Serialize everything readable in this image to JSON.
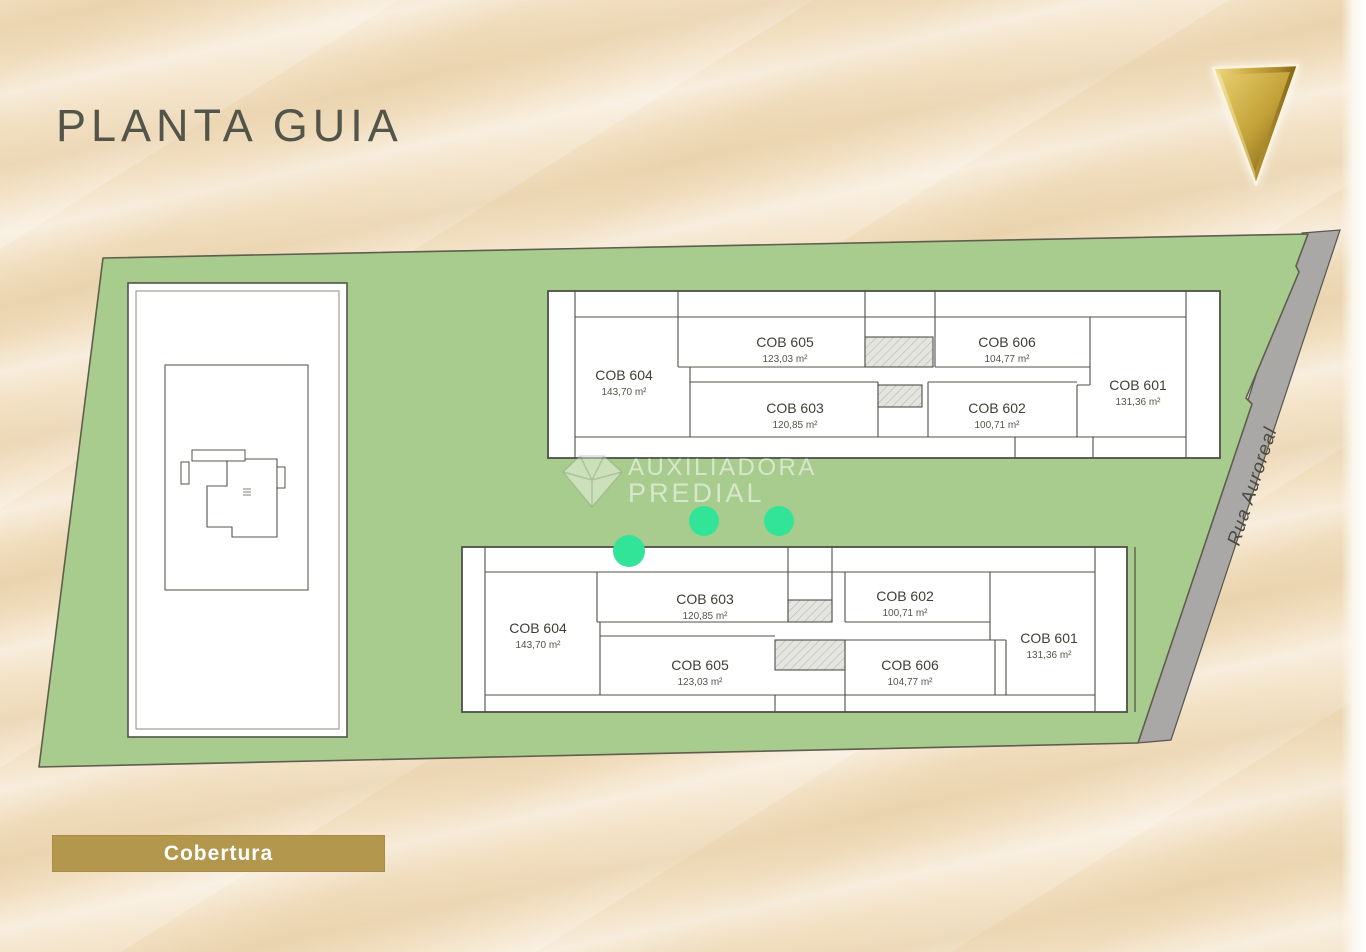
{
  "header": {
    "title": "PLANTA GUIA"
  },
  "legend": {
    "label": "Cobertura"
  },
  "street": {
    "name": "Rua Auroreal"
  },
  "watermark": {
    "line1": "AUXILIADORA",
    "line2": "PREDIAL"
  },
  "markers": {
    "count": 3
  },
  "buildings": {
    "top": {
      "units": {
        "cob604": {
          "id": "COB 604",
          "area": "143,70 m²"
        },
        "cob605": {
          "id": "COB 605",
          "area": "123,03 m²"
        },
        "cob606": {
          "id": "COB 606",
          "area": "104,77 m²"
        },
        "cob603": {
          "id": "COB 603",
          "area": "120,85 m²"
        },
        "cob602": {
          "id": "COB 602",
          "area": "100,71 m²"
        },
        "cob601": {
          "id": "COB 601",
          "area": "131,36 m²"
        }
      }
    },
    "bottom": {
      "units": {
        "cob604": {
          "id": "COB 604",
          "area": "143,70 m²"
        },
        "cob603": {
          "id": "COB 603",
          "area": "120,85 m²"
        },
        "cob602": {
          "id": "COB 602",
          "area": "100,71 m²"
        },
        "cob605": {
          "id": "COB 605",
          "area": "123,03 m²"
        },
        "cob606": {
          "id": "COB 606",
          "area": "104,77 m²"
        },
        "cob601": {
          "id": "COB 601",
          "area": "131,36 m²"
        }
      }
    }
  },
  "colors": {
    "background_beige": "#f2e0c2",
    "lot_green": "#a8cb8e",
    "street_gray": "#a9a8a6",
    "marker_green": "#32e498",
    "gold_bar": "#b2974d",
    "gold_triangle": "#c7a83d",
    "title_text": "#53544a",
    "plan_outline": "#4f4f48"
  }
}
